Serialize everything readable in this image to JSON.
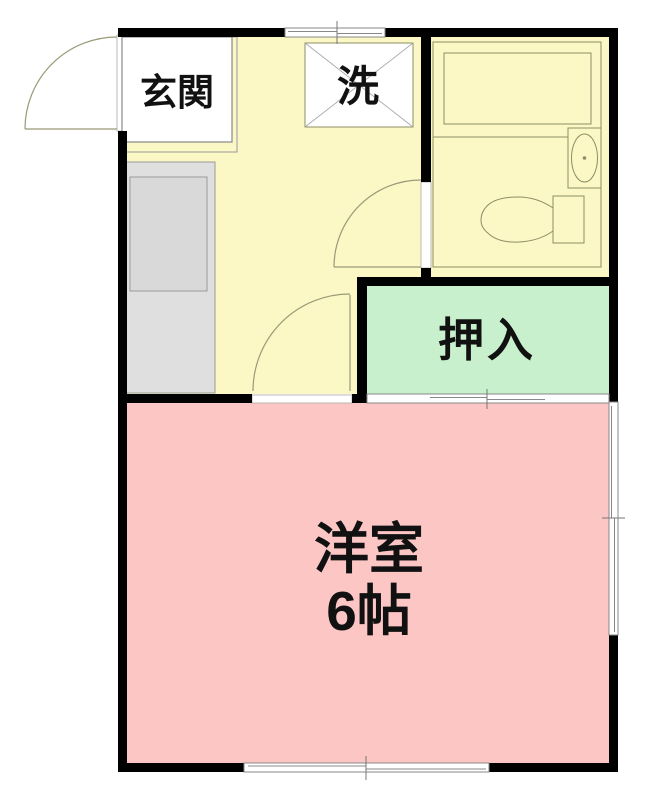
{
  "floorplan": {
    "type": "japanese-apartment-floor-plan",
    "rooms": {
      "genkan": {
        "label": "玄関"
      },
      "laundry": {
        "label": "洗"
      },
      "closet": {
        "label": "押入"
      },
      "western_room": {
        "name": "洋室",
        "size": "6帖"
      }
    },
    "fixtures": [
      "entrance-door",
      "bathtub",
      "bathroom-sink",
      "toilet",
      "kitchen-counter",
      "washing-machine-space"
    ],
    "colors": {
      "wall": "#000000",
      "kitchen_floor": "#FBF8C6",
      "bathroom_floor": "#FBF8C6",
      "closet_floor": "#C8F0CC",
      "western_room_floor": "#FCC6C5",
      "counter": "#DFDFDF",
      "counter_inner": "#D9D9D9",
      "fixture_line": "#8E8E66",
      "door_line": "#9A9A78",
      "window_line": "#888888",
      "tick_line": "#777777"
    }
  }
}
